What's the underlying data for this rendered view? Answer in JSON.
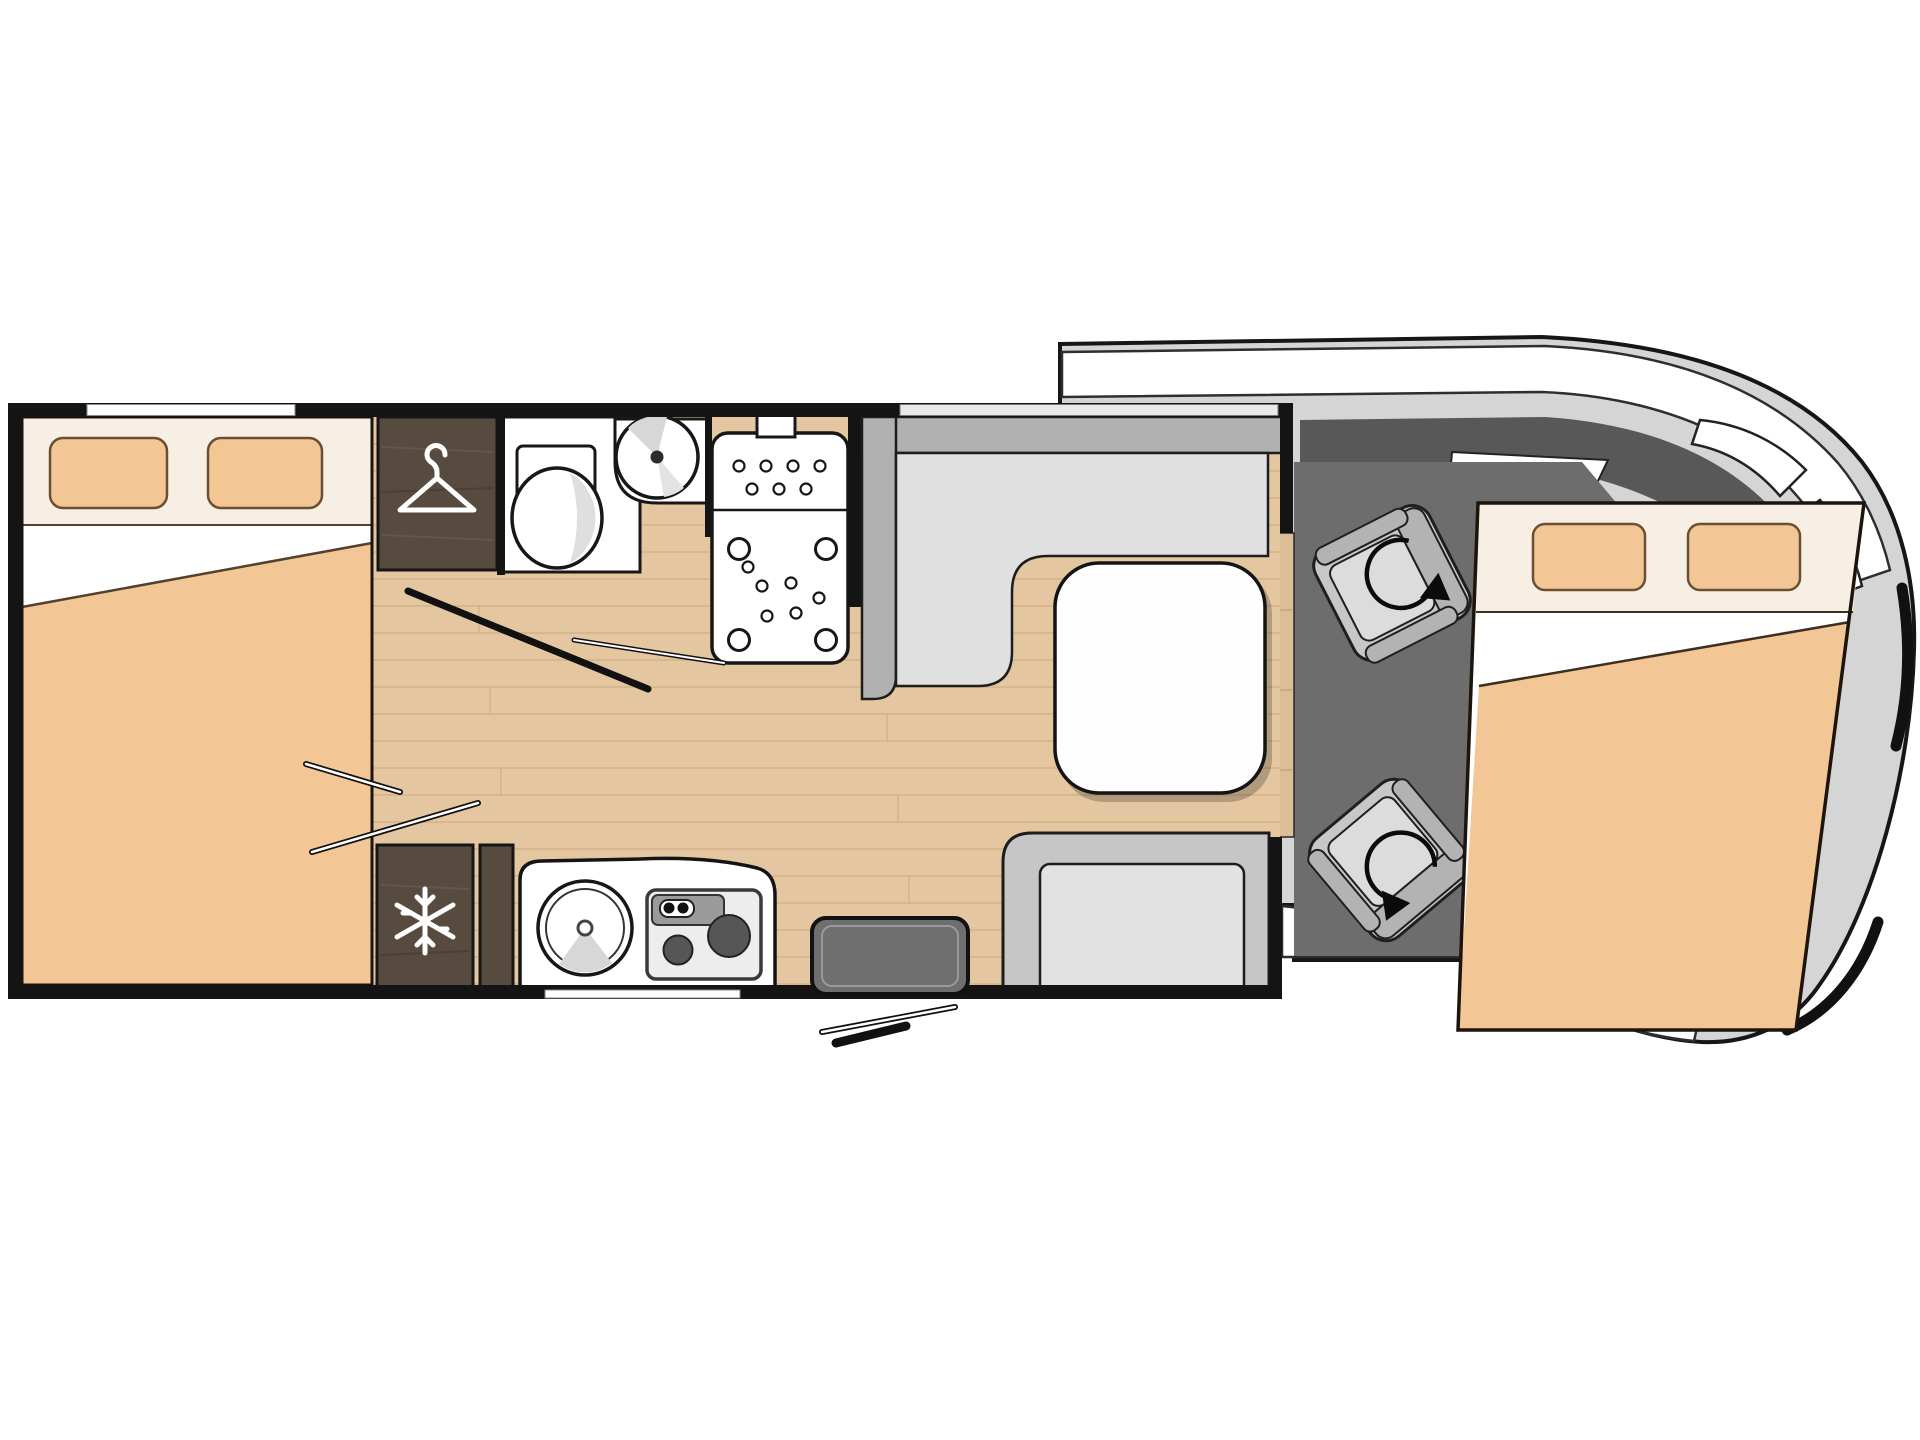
{
  "page": {
    "title": "Motorhome floor plan",
    "view": "top-down",
    "visible_text": []
  },
  "colors": {
    "background": "#ffffff",
    "wall": "#141414",
    "outline": "#171717",
    "floor": "#e4c7a1",
    "floor_line": "#b98f5e",
    "linen_white": "#ffffff",
    "headboard_cream": "#f8efe4",
    "peach": "#f3c795",
    "pillow_border": "#6b4f33",
    "wood_dark": "#574a3e",
    "gray_back": "#b1b1b1",
    "gray_cushion": "#e0e0e0",
    "bench_back": "#c6c6c6",
    "bench_cushion": "#e2e2e2",
    "table_white": "#fdfdfd",
    "cab_floor": "#6d6d6d",
    "windshield": "#585858",
    "body_gray": "#d5d5d5",
    "step_tan": "#dcbd96",
    "seat_base": "#c7c7c7",
    "seat_band": "#b3b3b3",
    "seat_cushion": "#dcdcdc",
    "burner_dark": "#565656",
    "hob_panel": "#9b9b9b",
    "door_gray": "#6f6f6f",
    "shading": "#d7d7d7"
  },
  "vehicle": {
    "type": "coachbuilt motorhome floorplan",
    "zones": [
      {
        "name": "rear-bedroom",
        "fixtures": [
          "double-bed",
          "two-pillows",
          "folded-duvet",
          "wardrobe"
        ]
      },
      {
        "name": "washroom",
        "fixtures": [
          "toilet",
          "round-washbasin",
          "shower-tray",
          "roof-vent"
        ]
      },
      {
        "name": "kitchen",
        "fixtures": [
          "refrigerator",
          "round-sink",
          "two-burner-hob",
          "base-cabinet"
        ]
      },
      {
        "name": "lounge",
        "fixtures": [
          "l-shaped-bench",
          "pedestal-table",
          "side-bench"
        ]
      },
      {
        "name": "entrance",
        "fixtures": [
          "entry-door",
          "door-swing-lines",
          "entry-step"
        ]
      },
      {
        "name": "cab",
        "fixtures": [
          "driver-swivel-seat",
          "passenger-swivel-seat",
          "windshield",
          "side-mirrors",
          "drop-down-bed"
        ]
      }
    ],
    "windows": [
      "rear-bedroom-window",
      "lounge-window"
    ]
  },
  "icons": [
    {
      "name": "hanger-icon",
      "represents": "wardrobe"
    },
    {
      "name": "snowflake-icon",
      "represents": "refrigerator"
    },
    {
      "name": "rotate-arrow-icon",
      "represents": "swivelling cab seat"
    }
  ]
}
